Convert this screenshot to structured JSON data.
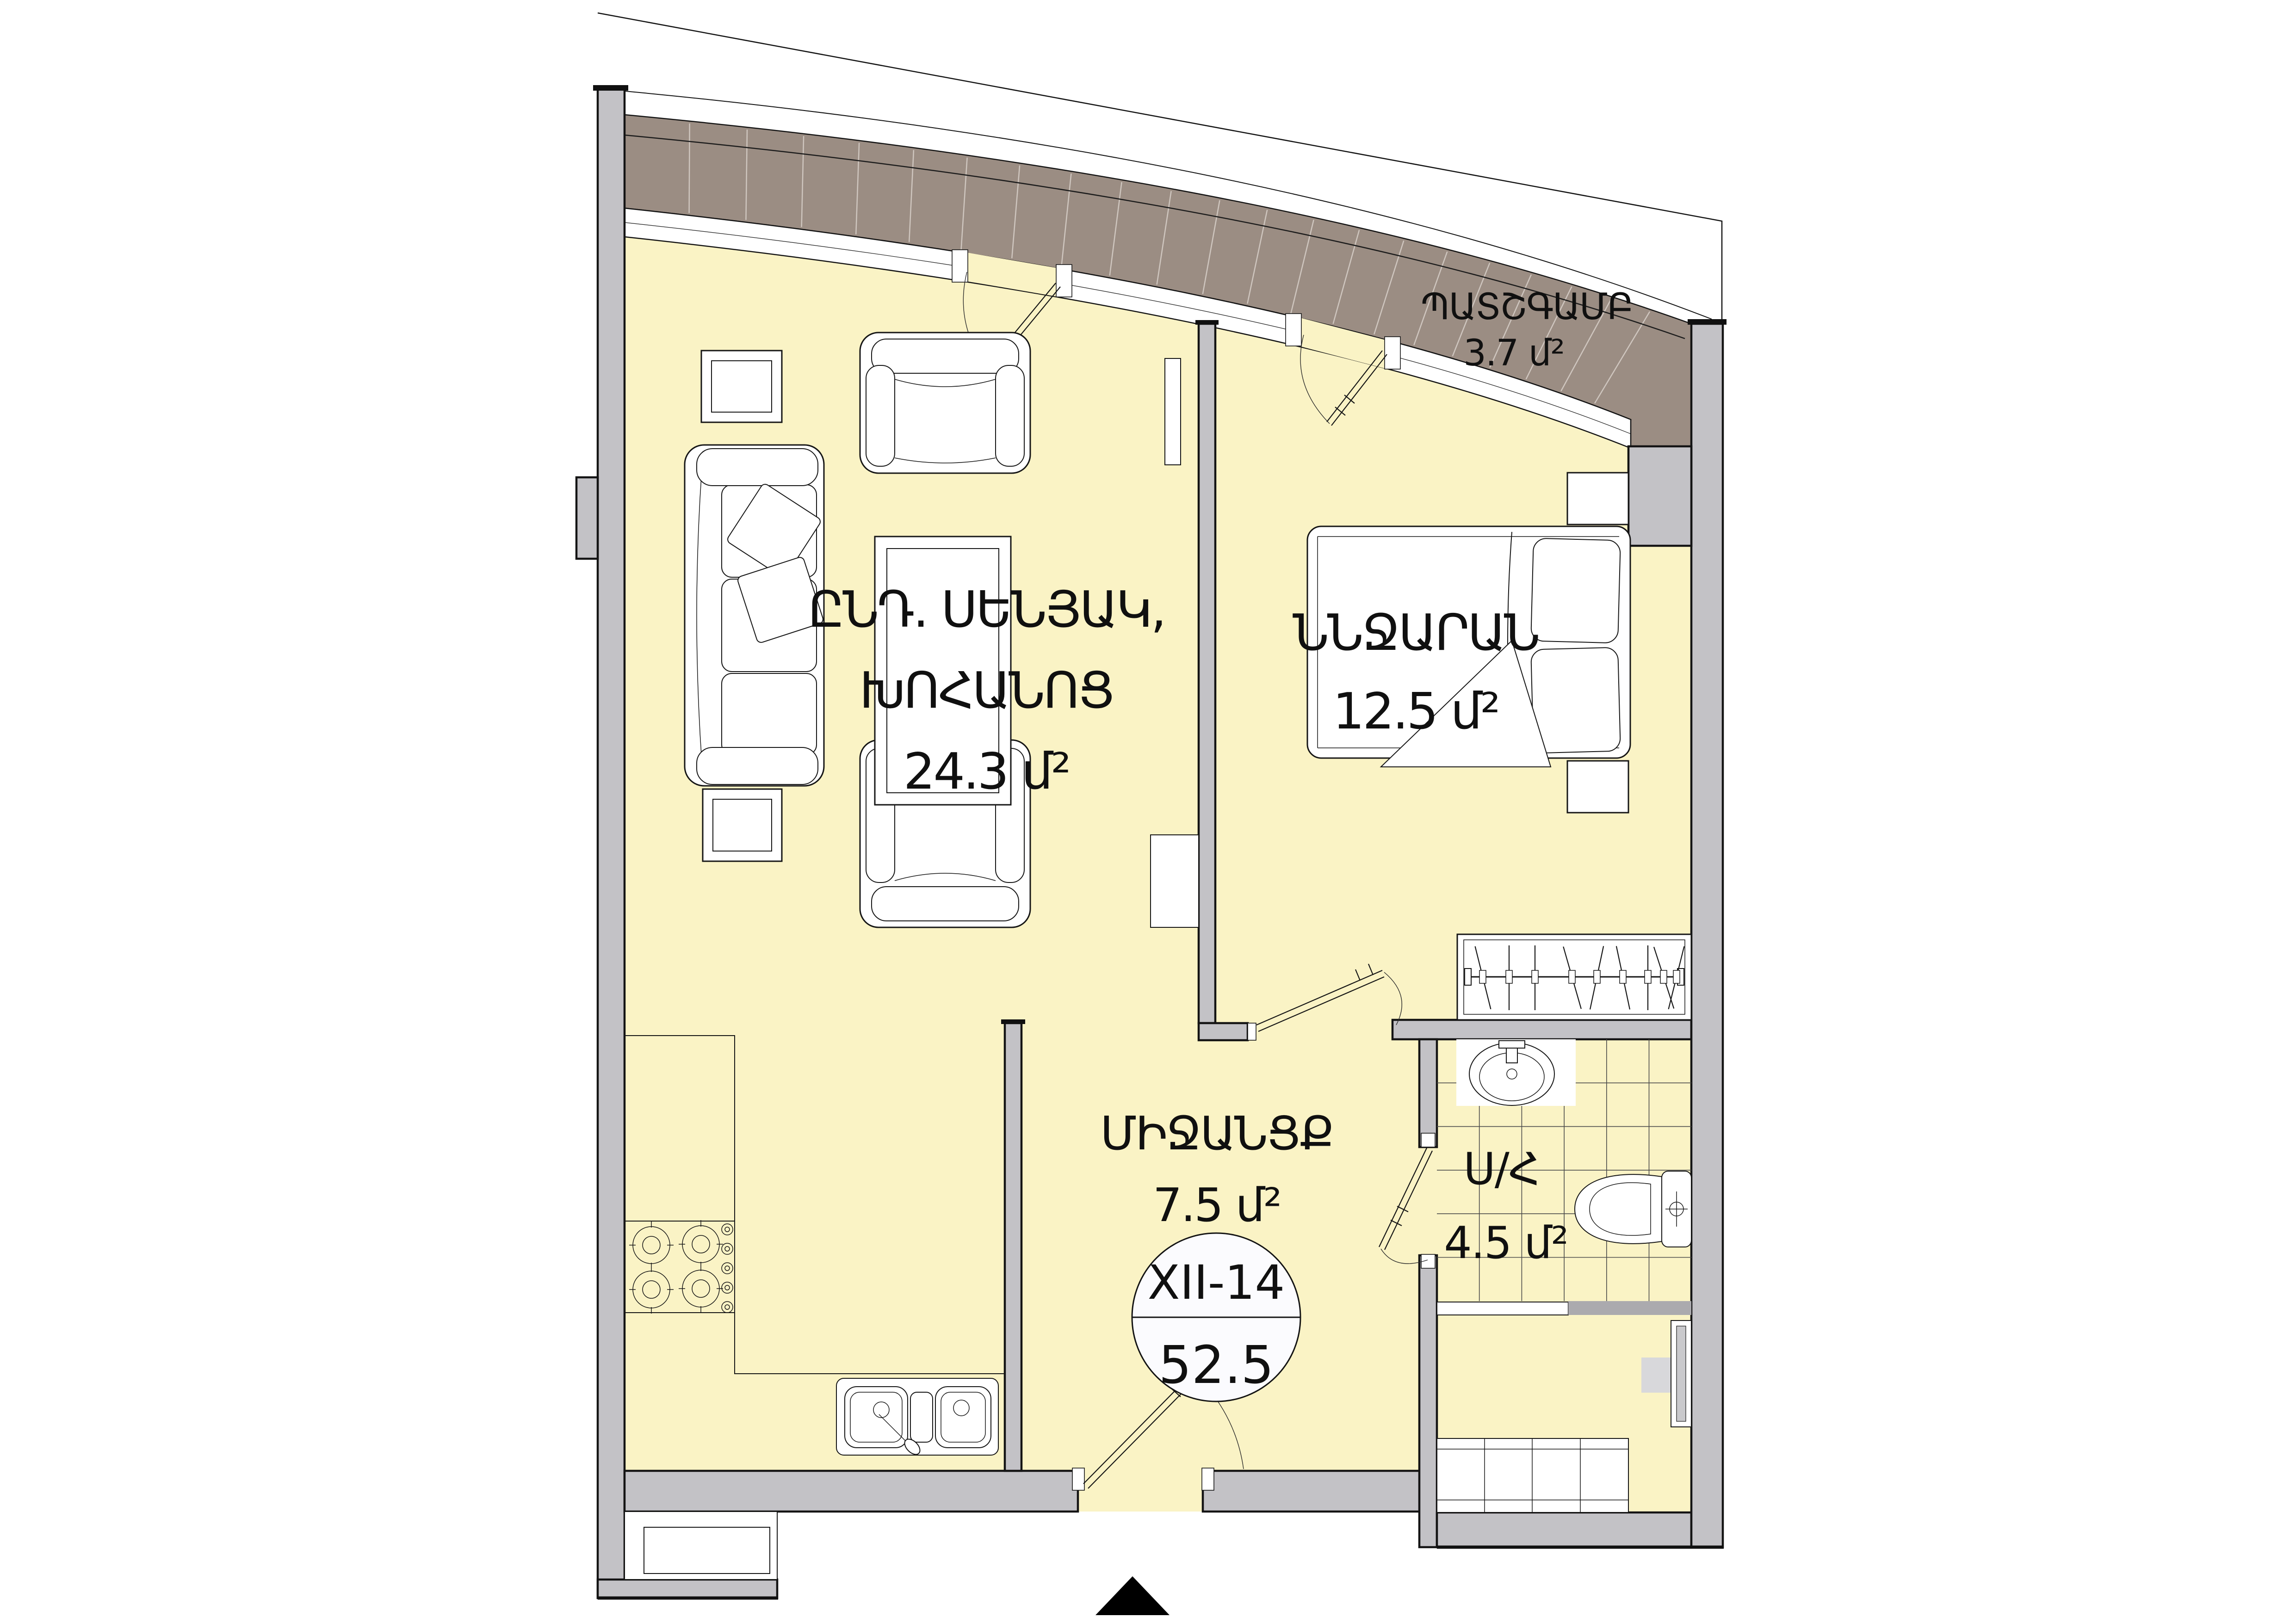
{
  "plan": {
    "unit_badge": {
      "code": "XII-14",
      "total_area": "52.5"
    },
    "rooms": {
      "living": {
        "name_line1": "ԸՆԴ. ՍԵՆՅԱԿ,",
        "name_line2": "ԽՈՀԱՆՈՑ",
        "area": "24.3 մ²"
      },
      "bedroom": {
        "name": "ՆՆՋԱՐԱՆ",
        "area": "12.5 մ²"
      },
      "hallway": {
        "name": "ՄԻՋԱՆՑՔ",
        "area": "7.5 մ²"
      },
      "bathroom": {
        "name": "Ս/Հ",
        "area": "4.5 մ²"
      },
      "balcony": {
        "name": "ՊԱՏՇԳԱՄԲ",
        "area": "3.7 մ²"
      }
    },
    "colors": {
      "floor": "#FAF3C5",
      "balcony_deck": "#9B8D83",
      "wall": "#C3C2C6",
      "outline": "#141414",
      "plank_line": "#CFC6BF",
      "tile_line": "#4a4a4a",
      "fixture_gray": "#D8D8DB"
    }
  }
}
